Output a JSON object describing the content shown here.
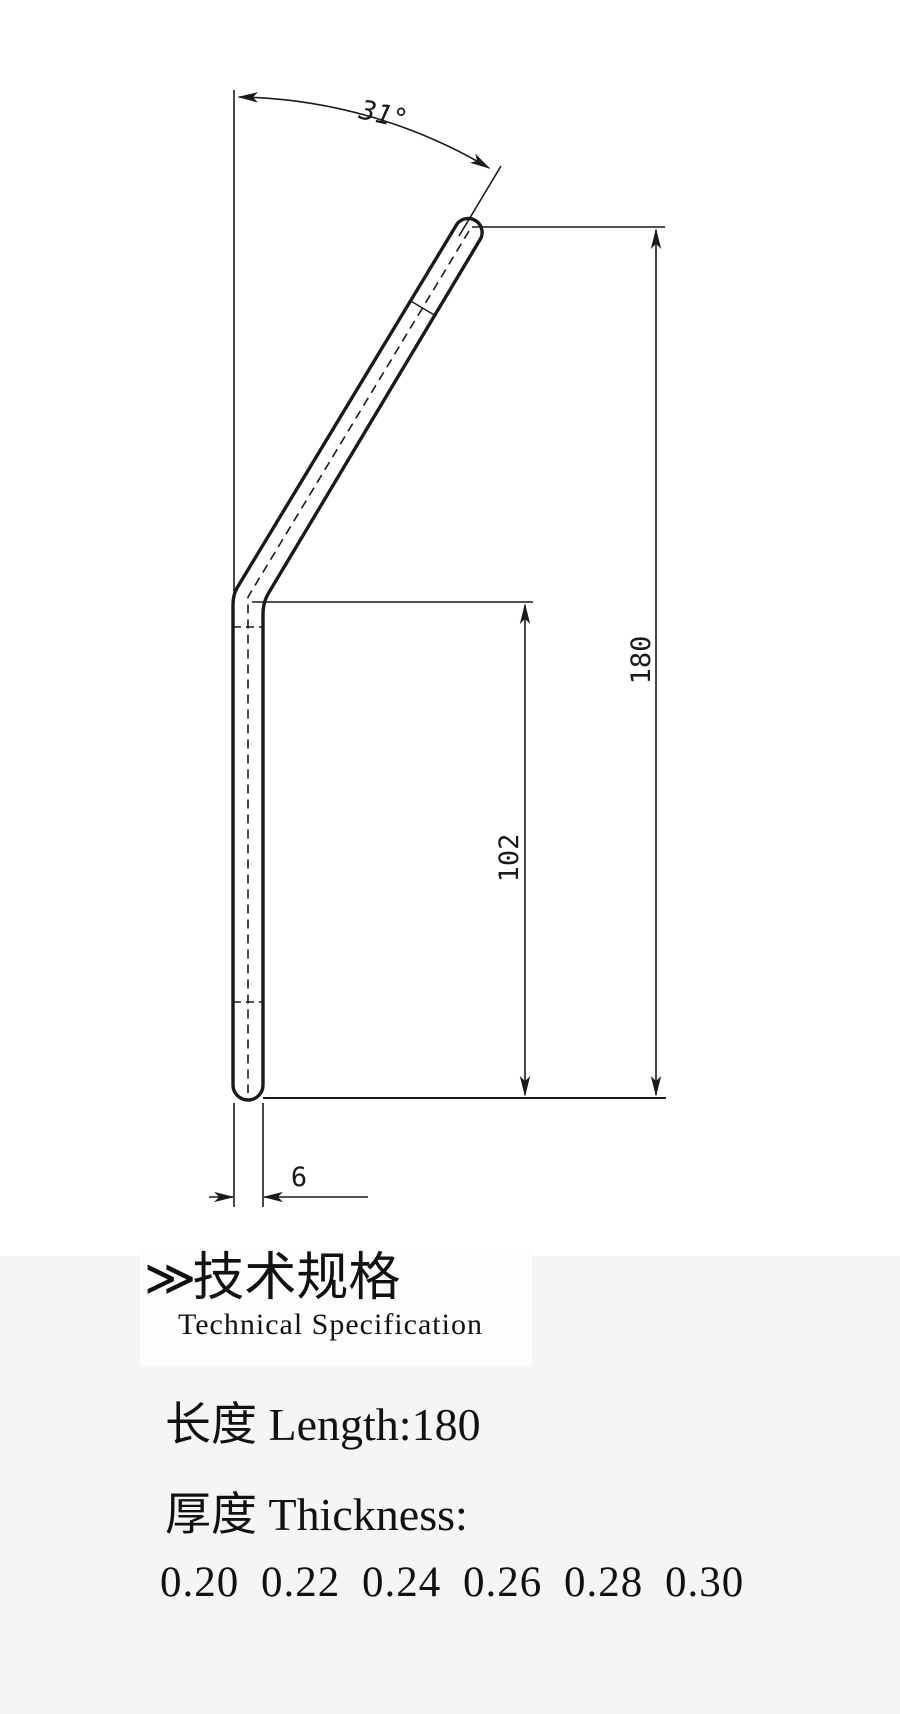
{
  "drawing": {
    "angle_label": "31°",
    "dim_total_length": "180",
    "dim_lower_length": "102",
    "dim_width": "6"
  },
  "spec": {
    "heading_chevron": "≫",
    "heading_cn": "技术规格",
    "heading_en": "Technical Specification",
    "length_line": "长度 Length:180",
    "thickness_line": "厚度 Thickness:",
    "thickness_values": "0.20 0.22 0.24 0.26 0.28 0.30"
  },
  "colors": {
    "line": "#1a1a1a",
    "background": "#ffffff",
    "panel_background": "#f5f5f5",
    "heading_box_background": "#fdfdfd"
  }
}
